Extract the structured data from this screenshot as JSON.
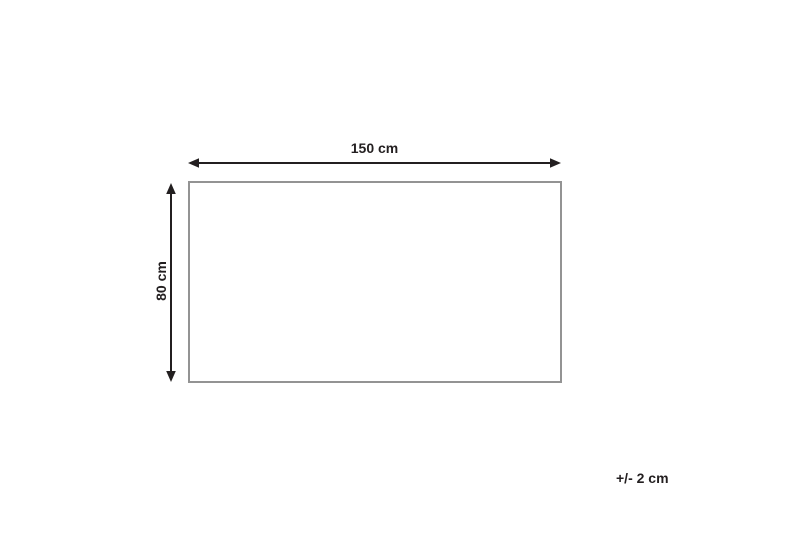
{
  "diagram": {
    "type": "product-dimension-diagram",
    "shape": "rectangle",
    "width_label": "150 cm",
    "height_label": "80 cm",
    "tolerance_label": "+/- 2 cm",
    "icons": {
      "width_arrow": "double-headed-horizontal-arrow",
      "height_arrow": "double-headed-vertical-arrow"
    },
    "colors": {
      "text": "#231f20",
      "arrow": "#231f20",
      "rect_border": "#939393",
      "background": "#ffffff"
    }
  }
}
